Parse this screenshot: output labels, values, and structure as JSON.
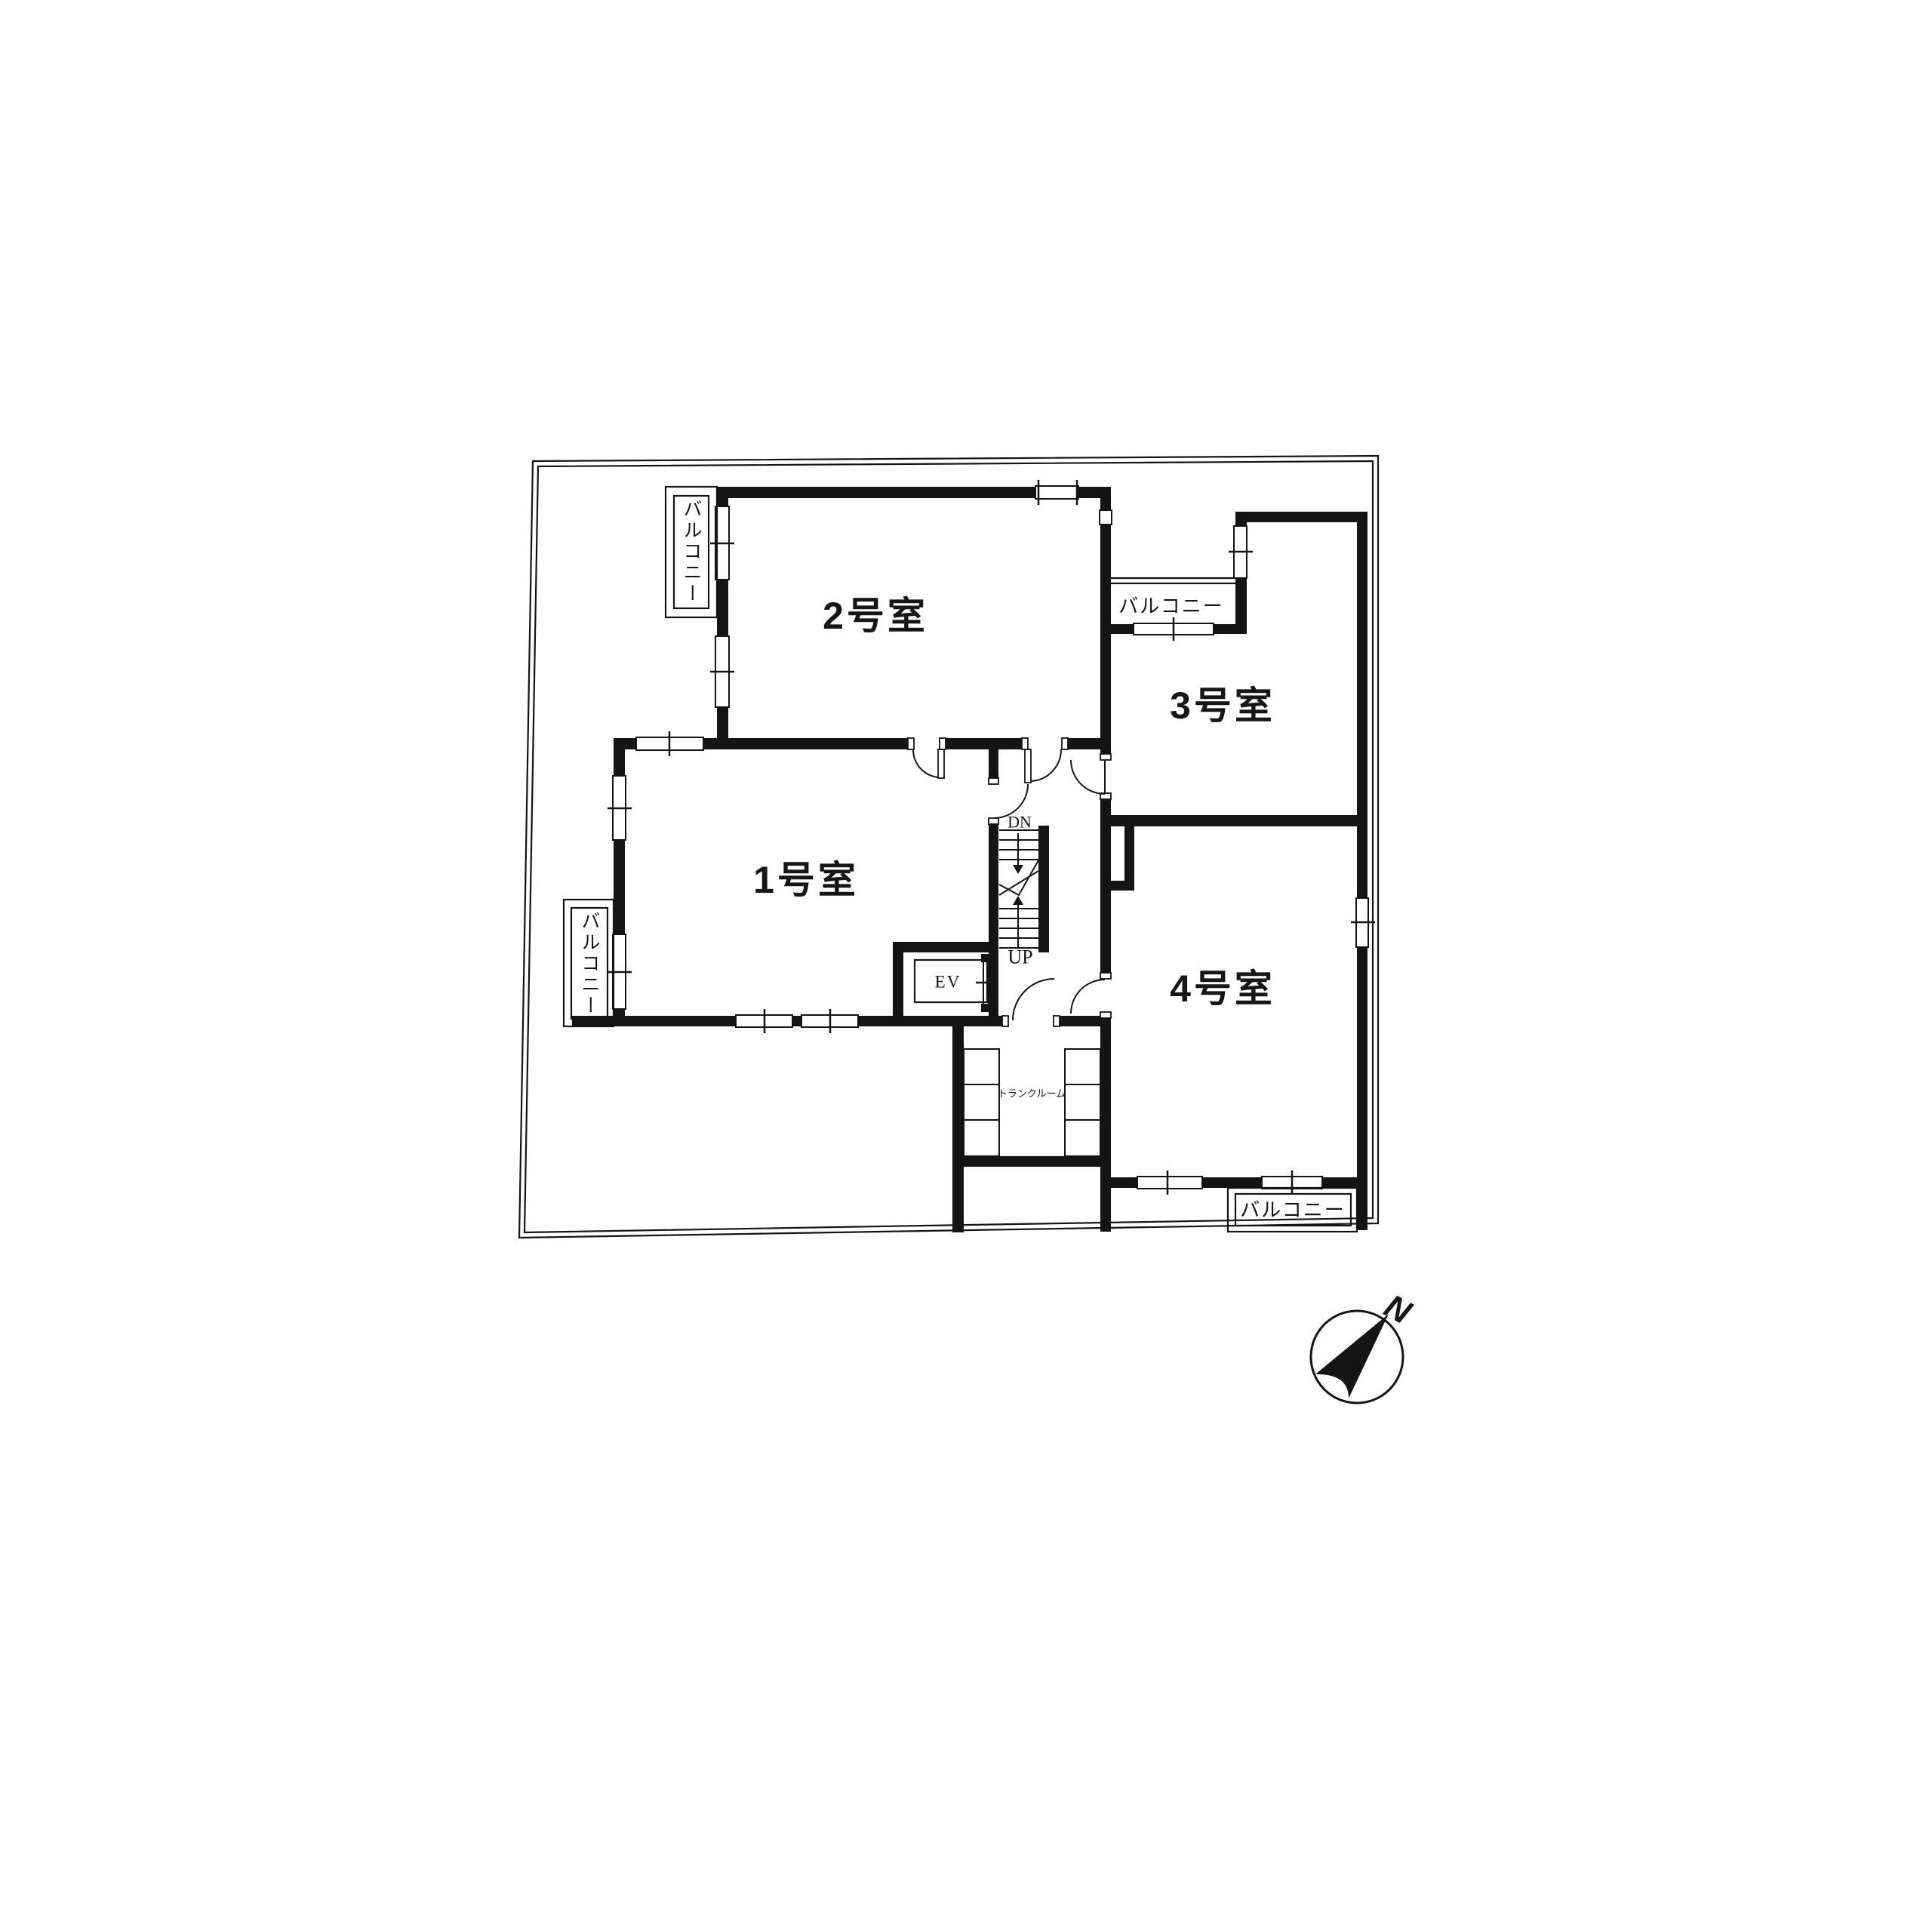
{
  "floor_plan": {
    "rooms": [
      {
        "id": 1,
        "label": "1号室"
      },
      {
        "id": 2,
        "label": "2号室"
      },
      {
        "id": 3,
        "label": "3号室"
      },
      {
        "id": 4,
        "label": "4号室"
      }
    ],
    "balcony_label": "バルコニー",
    "trunk_room_label": "トランクルーム",
    "elevator_label": "EV",
    "stairs": {
      "down": "DN",
      "up": "UP"
    },
    "compass_north": "N"
  }
}
